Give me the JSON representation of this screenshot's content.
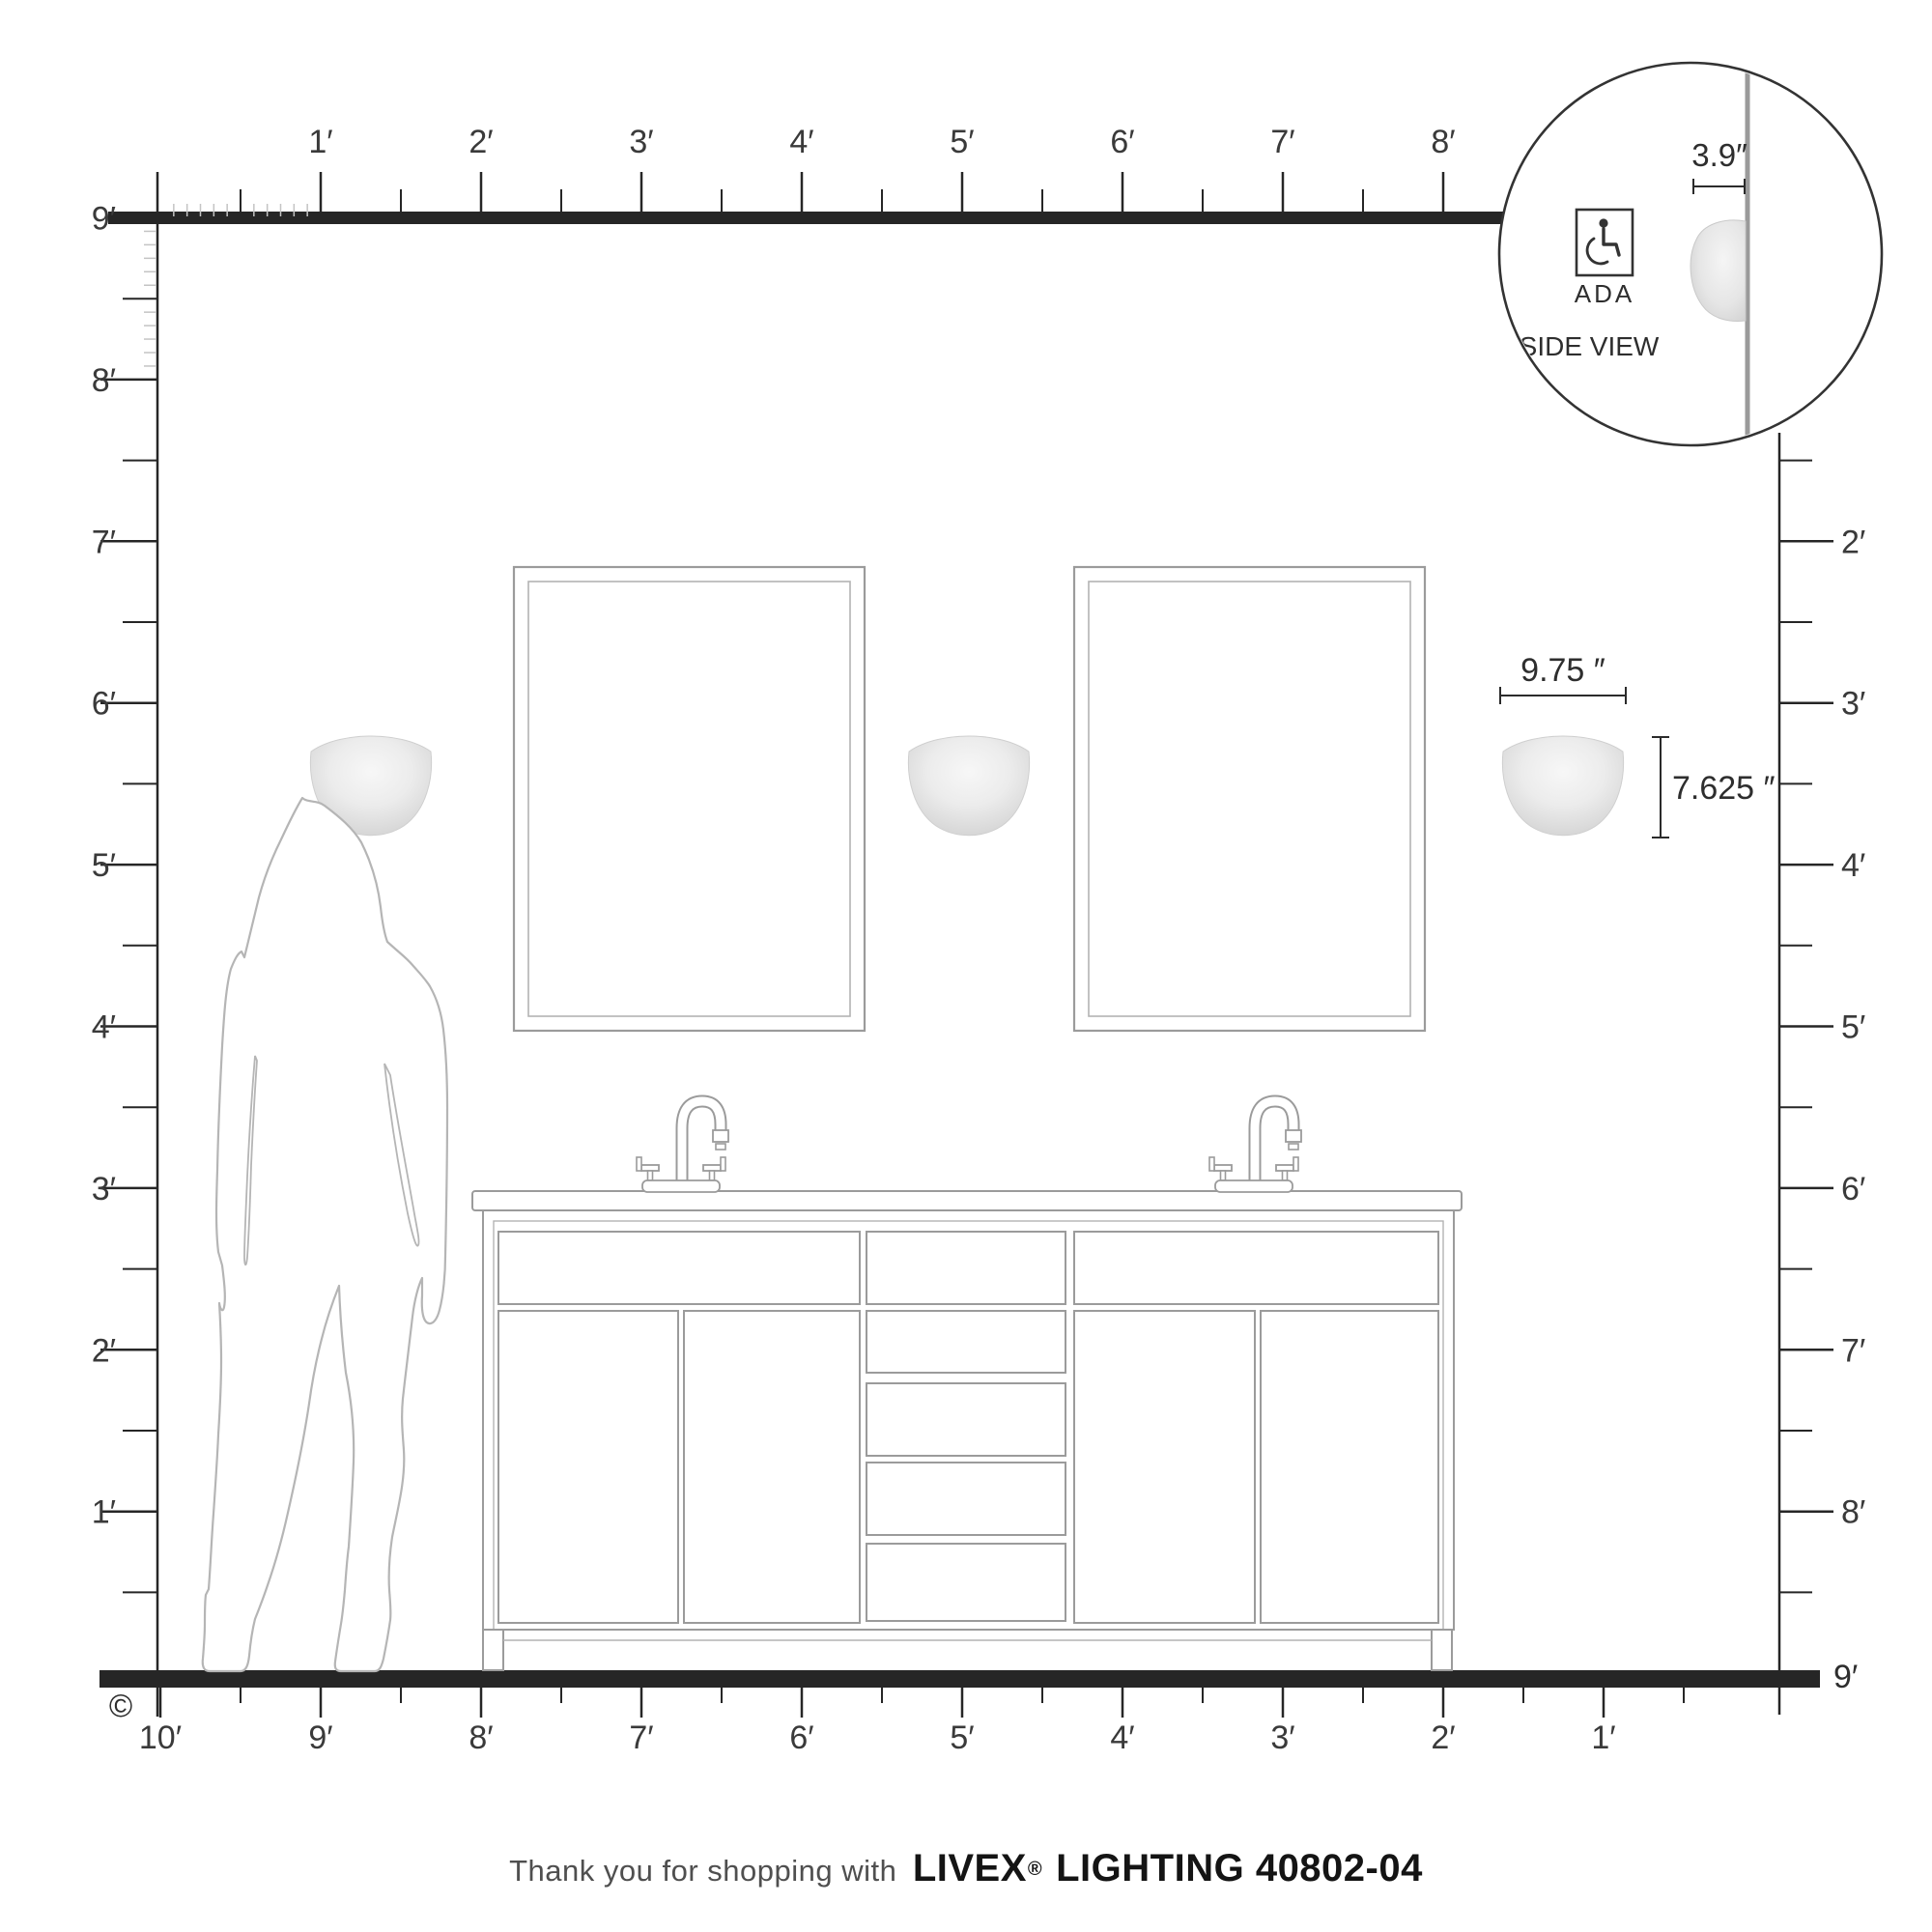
{
  "rulers": {
    "top": {
      "labels": [
        "1′",
        "2′",
        "3′",
        "4′",
        "5′",
        "6′",
        "7′",
        "8′"
      ]
    },
    "left": {
      "labels": [
        "9′",
        "8′",
        "7′",
        "6′",
        "5′",
        "4′",
        "3′",
        "2′",
        "1′"
      ]
    },
    "right": {
      "labels": [
        "2′",
        "3′",
        "4′",
        "5′",
        "6′",
        "7′",
        "8′",
        "9′"
      ]
    },
    "bottom": {
      "labels": [
        "10′",
        "9′",
        "8′",
        "7′",
        "6′",
        "5′",
        "4′",
        "3′",
        "2′",
        "1′"
      ]
    },
    "floor_right_label": "9′"
  },
  "dimensions": {
    "fixture_width": "9.75 ″",
    "fixture_height": "7.625 ″",
    "fixture_depth": "3.9″"
  },
  "inset": {
    "ada_label": "ADA",
    "side_view_label": "SIDE VIEW"
  },
  "footer": {
    "prefix": "Thank you for shopping with",
    "brand": "LIVEX",
    "registered": "®",
    "suffix": "LIGHTING 40802-04"
  },
  "copyright_symbol": "©",
  "colors": {
    "line_dark": "#262626",
    "label_text": "#3a3a3a",
    "line_mid": "#9b9b9b",
    "line_inner": "#b3b3b3",
    "tick_light": "#c4c4c4",
    "silhouette": "#b5b5b5",
    "wall_gray": "#9a9a9a",
    "sconce_light": "#f6f6f6",
    "sconce_dark": "#d2d2d2"
  }
}
